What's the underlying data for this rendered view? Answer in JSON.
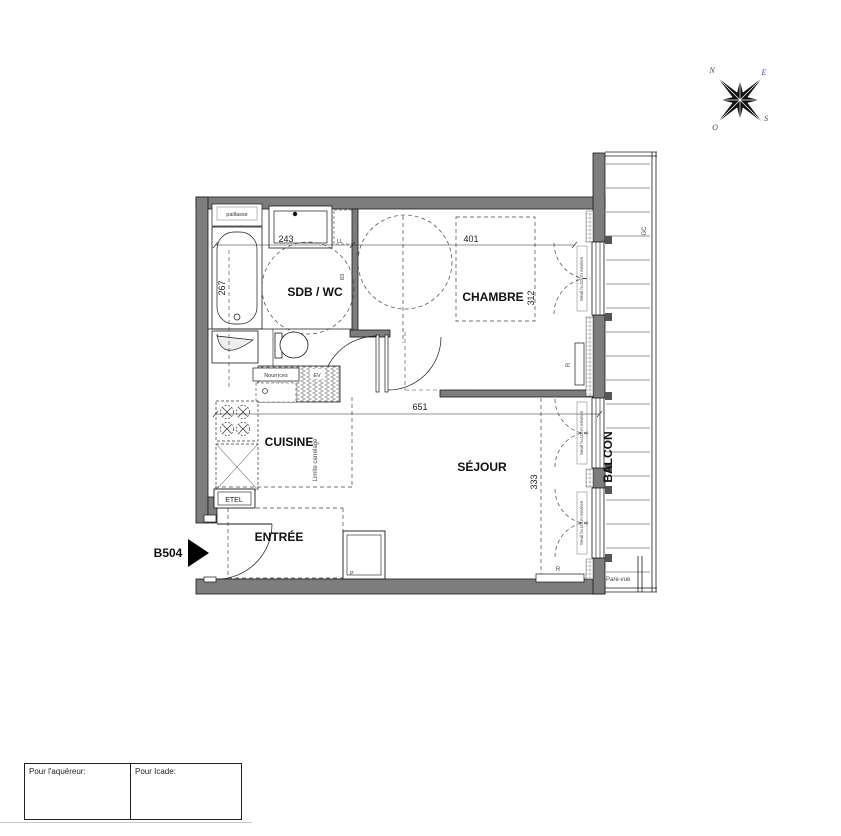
{
  "compass": {
    "n": "N",
    "e": "E",
    "s": "S",
    "o": "O"
  },
  "plan": {
    "unit_label": "B504",
    "rooms": {
      "sdb": "SDB / WC",
      "chambre": "CHAMBRE",
      "cuisine": "CUISINE",
      "sejour": "SÉJOUR",
      "entree": "ENTRÉE",
      "balcon": "BALCON"
    },
    "dimensions": {
      "sdb_width": "243",
      "sdb_depth": "267",
      "chambre_width": "401",
      "chambre_depth": "312",
      "sejour_width": "651",
      "sejour_depth": "333",
      "door": "83"
    },
    "annotations": {
      "paillasse": "paillasse",
      "ll": "LL",
      "nourrices": "Nourrices",
      "ev": "EV",
      "etel": "ETEL",
      "limite_carrelage": "Limite carrelage",
      "seuil": "Seuil h=10cm environ",
      "gc": "GC",
      "radiator": "R",
      "pare_vue": "Pare-vue",
      "placard": "P"
    }
  },
  "title_block": {
    "acquirer_label": "Pour l'aquéreur:",
    "icade_label": "Pour Icade:"
  }
}
